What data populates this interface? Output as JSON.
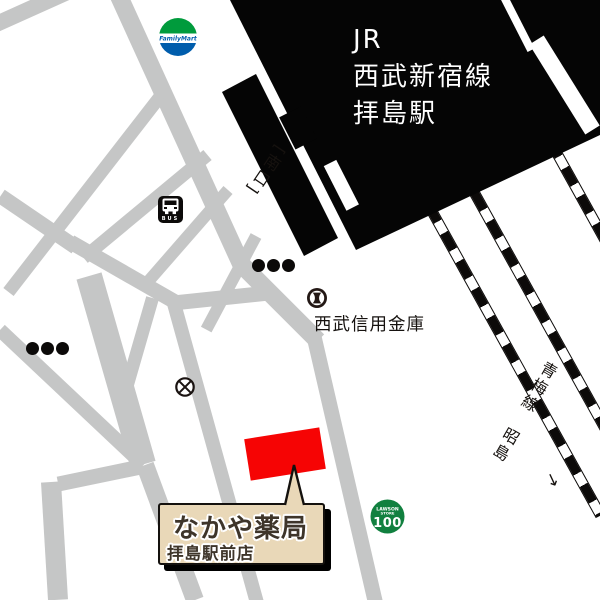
{
  "station": {
    "name_line1": "JR",
    "name_line2": "西武新宿線",
    "name_line3": "拝島駅",
    "south_exit_label": "[南口]"
  },
  "railway": {
    "line_label": "青梅線　昭島",
    "direction_arrow": "→"
  },
  "pois": {
    "bank_label": "西武信用金庫",
    "police_box_symbol": "crossed-circle (koban map symbol)",
    "bank_symbol": "fundo bank map symbol"
  },
  "destination": {
    "name": "なかや薬局",
    "branch": "拝島駅前店",
    "marker": "red rotated rectangle building"
  },
  "icons": {
    "familymart": {
      "text": "FamilyMart",
      "green": "#009b3c",
      "blue": "#005dac"
    },
    "lawson": {
      "line1": "LAWSON",
      "line2": "STORE",
      "line3": "100",
      "green": "#11803f"
    },
    "bus": {
      "text": "BUS"
    }
  },
  "colors": {
    "road_gray": "#c5c6c6",
    "station_black": "#050505",
    "marker_red": "#f60404",
    "callout_beige": "#e9d8b8",
    "text_dark": "#16120f"
  }
}
